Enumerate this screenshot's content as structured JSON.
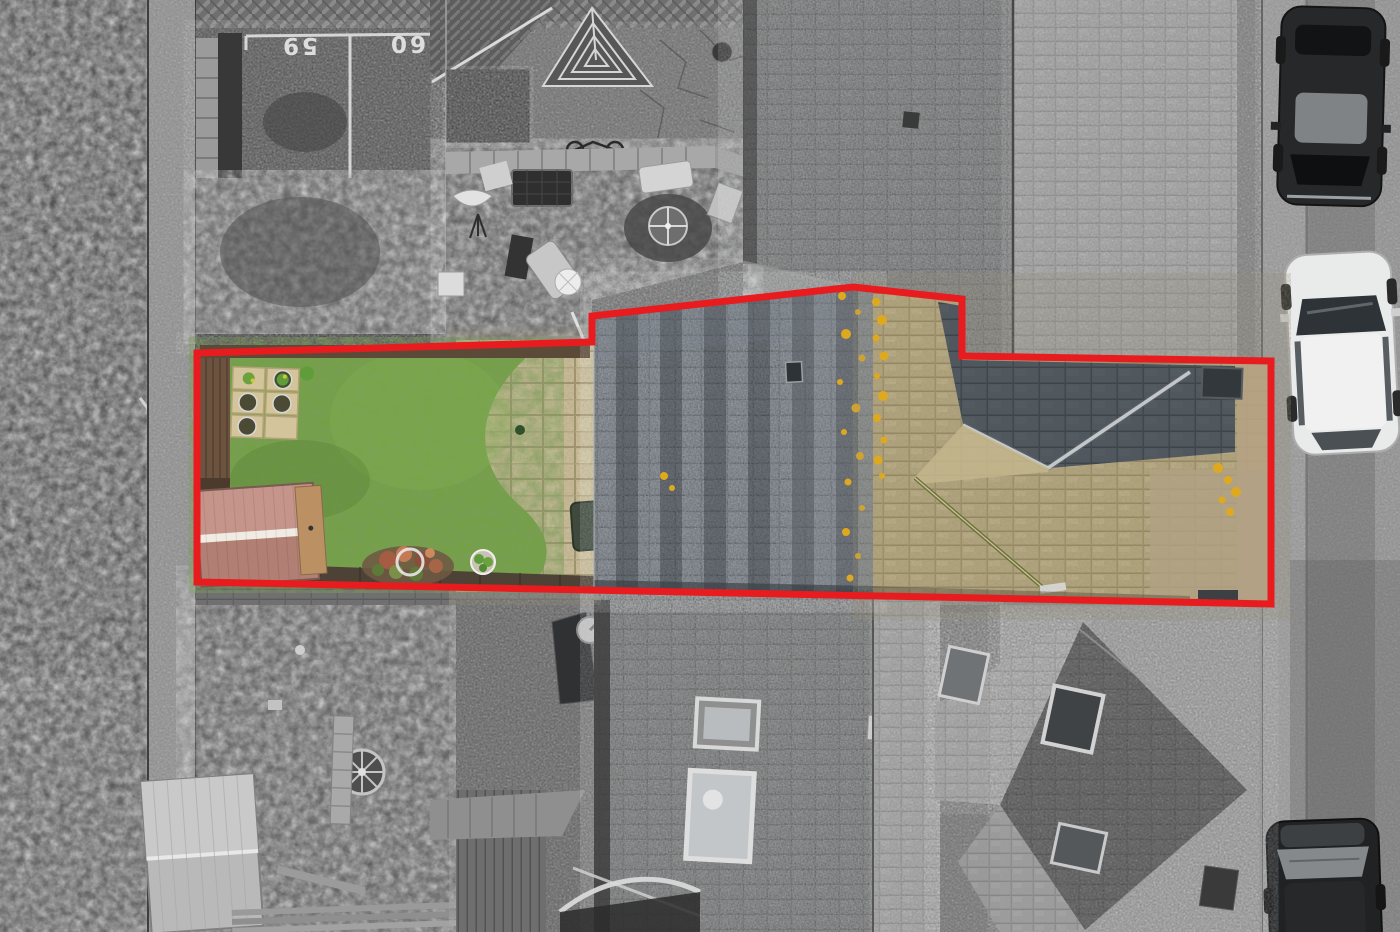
{
  "image": {
    "kind": "aerial-drone-photo",
    "description": "Top-down estate-agent drone photo of a terraced property; the plot for sale is shown in full colour and outlined in red while all surrounding land is desaturated grey.",
    "width_px": 1400,
    "height_px": 932
  },
  "overlay": {
    "boundary_color": "#e81c1f",
    "boundary_stroke_px": 7,
    "points": "197,353 592,342 592,316 853,287 962,299 962,356 1271,361 1271,604 197,582"
  },
  "parking": {
    "bay_numbers": [
      "59",
      "60"
    ],
    "number_color": "#ededed",
    "note": "numbers painted on tarmac, viewed upside-down from above"
  },
  "plot": {
    "lawn_color": "#72a143",
    "patio_color": "#cfc19b",
    "shed_roof_light": "#c5948a",
    "shed_roof_dark": "#b17f74",
    "shed_ridge": "#f0ece4",
    "shed_timber_end": "#bb9063",
    "front_roof_slate": "#59626b",
    "rear_roof_tan": "#b4a67d",
    "rear_roof_shadow": "#3b4147",
    "lichen_gold": "#dfa91f",
    "decking_color": "#4e4236",
    "features": [
      "green-lawn",
      "curved-paved-patio",
      "garden-shed",
      "planter-slabs-with-pots",
      "flower-bed",
      "hose-ring",
      "potted-plant",
      "bbq-cover",
      "front-slate-roof",
      "rear-hipped-tan-roof",
      "valley-flashing",
      "side-driveway",
      "wheelie-bin",
      "roof-vent"
    ]
  },
  "street": {
    "surface_color": "#8e8e8e",
    "cars": [
      {
        "name": "dark-car-top",
        "body_color": "#26282a",
        "position": "top-right"
      },
      {
        "name": "white-car",
        "body_color": "#e9eaea",
        "position": "middle-right"
      },
      {
        "name": "dark-car-bottom",
        "body_color": "#202224",
        "position": "bottom-right"
      }
    ]
  },
  "surroundings": {
    "desaturated": true,
    "features": [
      "numbered-parking-bays",
      "herringbone-brick-path",
      "hedge-strip",
      "glass-pyramid-skylight",
      "crazy-paving-patio",
      "garden-walkway",
      "hot-tub-cover",
      "sun-loungers",
      "hammock",
      "rotary-dryer",
      "garden-table",
      "bicycle",
      "large-tiled-roof",
      "white-shed",
      "wagon-wheel-ornament",
      "deck-planks",
      "satellite-dish",
      "closed-parasol",
      "roof-windows",
      "rear-hip-roof-neighbour",
      "wheelie-bin",
      "pavement-and-road"
    ]
  }
}
